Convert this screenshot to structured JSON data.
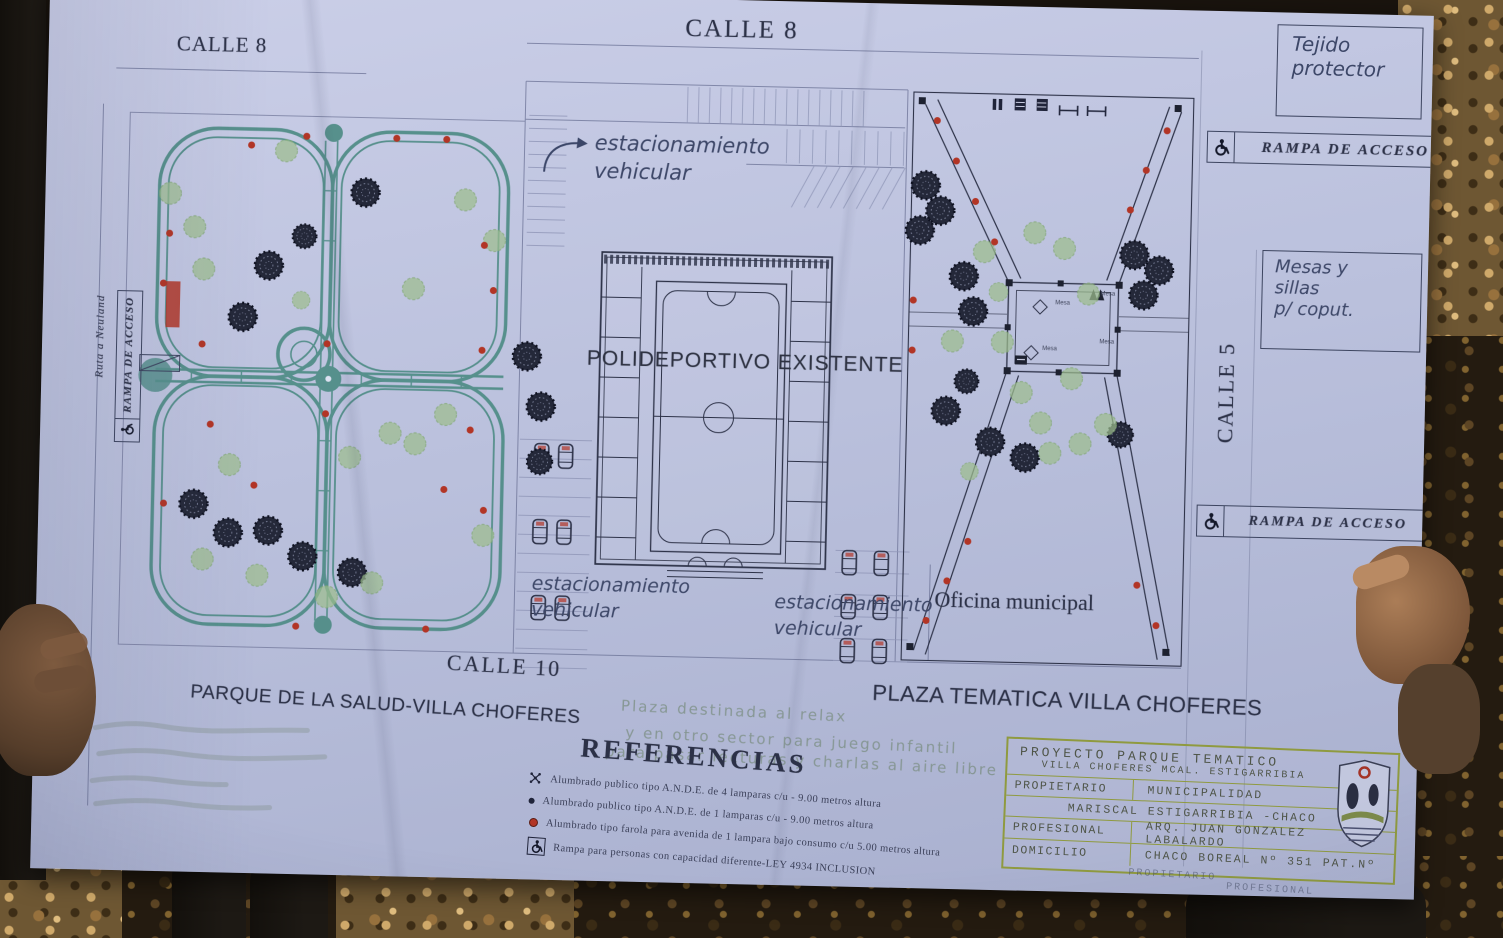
{
  "colors": {
    "paper_tint": "#bfc5e0",
    "ink": "#2c3147",
    "path_teal": "#4e8b85",
    "tree_green": "#9dbd8d",
    "accent_red": "#b23526",
    "titleblock_green": "#8f9a3f"
  },
  "plan": {
    "streets": {
      "calle8_left": "CALLE 8",
      "calle8_top": "CALLE 8",
      "calle5": "CALLE 5",
      "calle10": "CALLE 10"
    },
    "margin": {
      "tejido_lines": [
        "Tejido",
        "protector"
      ],
      "mesas_lines": [
        "Mesas y",
        "sillas",
        "p/ coput."
      ],
      "rampa_acceso": "RAMPA DE ACCESO",
      "ruta_neuland": "Ruta a Neuland"
    },
    "labels": {
      "estacionamiento": "estacionamiento vehicular",
      "polideportivo": "POLIDEPORTIVO EXISTENTE",
      "oficina_municipal": "Oficina municipal",
      "parque_title": "PARQUE DE LA SALUD-VILLA CHOFERES",
      "plaza_title": "PLAZA TEMATICA  VILLA CHOFERES",
      "mesa": "Mesa"
    },
    "notes": [
      "Plaza destinada al relax",
      "y en otro sector para juego infantil",
      "para pasar lecturas y charlas al aire libre"
    ],
    "referencias": {
      "title": "REFERENCIAS",
      "items": [
        {
          "icon": "four-lamp-post-icon",
          "text": "Alumbrado publico tipo A.N.D.E. de 4 lamparas c/u - 9.00 metros altura"
        },
        {
          "icon": "one-lamp-post-icon",
          "text": "Alumbrado publico tipo A.N.D.E. de 1 lamparas c/u - 9.00 metros altura"
        },
        {
          "icon": "farola-lamp-icon",
          "text": "Alumbrado tipo farola para avenida de 1 lampara bajo consumo c/u 5.00 metros altura"
        },
        {
          "icon": "wheelchair-icon",
          "text": "Rampa para personas con capacidad diferente-LEY 4934 INCLUSION"
        }
      ]
    },
    "title_block": {
      "project_line1": "PROYECTO PARQUE TEMATICO",
      "project_line2": "VILLA CHOFERES MCAL. ESTIGARRIBIA",
      "propietario_label": "PROPIETARIO",
      "propietario_value": "MUNICIPALIDAD",
      "propietario_value2": "MARISCAL ESTIGARRIBIA -CHACO",
      "profesional_label": "PROFESIONAL",
      "profesional_value": "ARQ. JUAN GONZALEZ LABALARDO",
      "domicilio_label": "DOMICILIO",
      "domicilio_value": "CHACO BOREAL Nº 351 PAT.Nº",
      "signature_left": "PROPIETARIO",
      "signature_right": "PROFESIONAL"
    }
  }
}
